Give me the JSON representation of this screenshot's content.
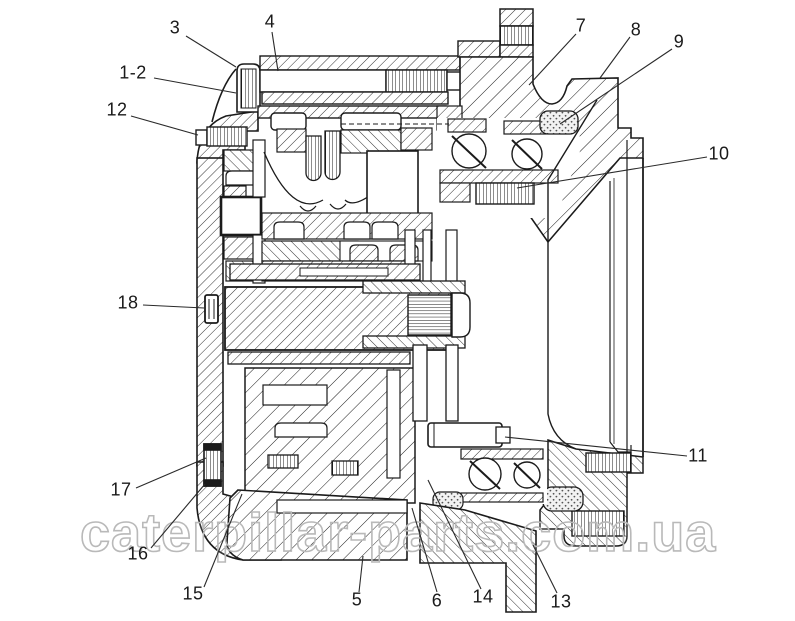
{
  "diagram": {
    "title": "Final drive assembly cross-section diagram",
    "type": "technical-cross-section"
  },
  "watermark": {
    "text": "caterpillar-parts.com.ua",
    "color": "#b9b9b9"
  },
  "colors": {
    "ink": "#1b1b1b",
    "paper": "#ffffff",
    "leader": "#2a2a2a"
  },
  "callouts": [
    {
      "label": "3",
      "x": 175,
      "y": 28,
      "line": [
        186,
        36,
        236,
        67
      ]
    },
    {
      "label": "4",
      "x": 270,
      "y": 22,
      "line": [
        272,
        32,
        278,
        71
      ]
    },
    {
      "label": "1-2",
      "x": 133,
      "y": 73,
      "line": [
        154,
        78,
        236,
        93
      ]
    },
    {
      "label": "12",
      "x": 117,
      "y": 110,
      "line": [
        131,
        116,
        198,
        135
      ]
    },
    {
      "label": "18",
      "x": 128,
      "y": 303,
      "line": [
        143,
        305,
        204,
        308
      ]
    },
    {
      "label": "17",
      "x": 121,
      "y": 490,
      "line": [
        136,
        488,
        206,
        458
      ]
    },
    {
      "label": "16",
      "x": 138,
      "y": 554,
      "line": [
        151,
        548,
        205,
        484
      ]
    },
    {
      "label": "15",
      "x": 193,
      "y": 594,
      "line": [
        204,
        587,
        242,
        494
      ]
    },
    {
      "label": "5",
      "x": 357,
      "y": 600,
      "line": [
        359,
        592,
        363,
        556
      ]
    },
    {
      "label": "6",
      "x": 437,
      "y": 601,
      "line": [
        437,
        592,
        412,
        508
      ]
    },
    {
      "label": "14",
      "x": 483,
      "y": 597,
      "line": [
        481,
        589,
        428,
        480
      ]
    },
    {
      "label": "13",
      "x": 561,
      "y": 602,
      "line": [
        557,
        593,
        533,
        545
      ]
    },
    {
      "label": "7",
      "x": 581,
      "y": 26,
      "line": [
        576,
        34,
        529,
        85
      ]
    },
    {
      "label": "8",
      "x": 636,
      "y": 30,
      "line": [
        630,
        37,
        600,
        78
      ]
    },
    {
      "label": "9",
      "x": 679,
      "y": 42,
      "line": [
        672,
        49,
        560,
        124
      ]
    },
    {
      "label": "10",
      "x": 719,
      "y": 154,
      "line": [
        707,
        157,
        517,
        188
      ]
    },
    {
      "label": "11",
      "x": 698,
      "y": 456,
      "line": [
        687,
        456,
        505,
        437
      ]
    }
  ]
}
